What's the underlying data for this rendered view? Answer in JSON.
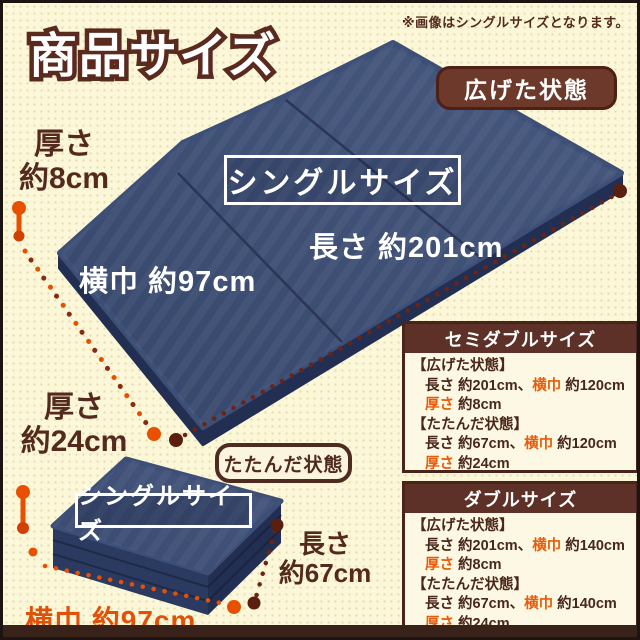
{
  "page": {
    "title": "商品サイズ",
    "note": "※画像はシングルサイズとなります。"
  },
  "badges": {
    "open": "広げた状態",
    "folded": "たたんだ状態"
  },
  "open_mattress": {
    "size_label": "シングルサイズ",
    "length": "長さ 約201cm",
    "width": "横巾 約97cm",
    "thickness_line1": "厚さ",
    "thickness_line2": "約8cm"
  },
  "folded_mattress": {
    "size_label": "シングルサイズ",
    "thickness_line1": "厚さ",
    "thickness_line2": "約24cm",
    "length_line1": "長さ",
    "length_line2": "約67cm",
    "width": "横巾 約97cm"
  },
  "size_boxes": [
    {
      "title": "セミダブルサイズ",
      "open_header": "【広げた状態】",
      "open_length": "長さ 約201cm、",
      "open_width_label": "横巾",
      "open_width_value": " 約120cm",
      "open_thick_label": "厚さ",
      "open_thick_value": " 約8cm",
      "folded_header": "【たたんだ状態】",
      "folded_length": "長さ 約67cm、",
      "folded_width_label": "横巾",
      "folded_width_value": " 約120cm",
      "folded_thick_label": "厚さ",
      "folded_thick_value": " 約24cm"
    },
    {
      "title": "ダブルサイズ",
      "open_header": "【広げた状態】",
      "open_length": "長さ 約201cm、",
      "open_width_label": "横巾",
      "open_width_value": " 約140cm",
      "open_thick_label": "厚さ",
      "open_thick_value": " 約8cm",
      "folded_header": "【たたんだ状態】",
      "folded_length": "長さ 約67cm、",
      "folded_width_label": "横巾",
      "folded_width_value": " 約140cm",
      "folded_thick_label": "厚さ",
      "folded_thick_value": " 約24cm"
    }
  ],
  "colors": {
    "background": "#FBF7D8",
    "dark_brown_text": "#54291E",
    "badge_brown": "#6C392B",
    "box_header_brown": "#5D3127",
    "mattress_navy": "#3D4E78",
    "orange_accent": "#E75B0A",
    "orange_dots": "#E85000",
    "dark_dots": "#6B2412"
  }
}
